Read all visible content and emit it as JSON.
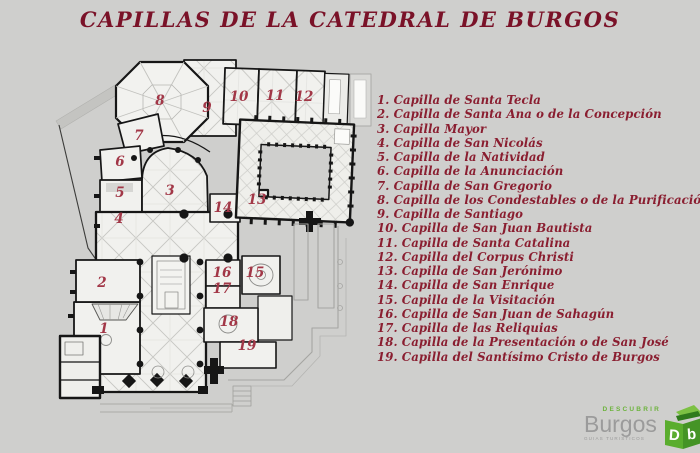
{
  "title": {
    "text": "CAPILLAS DE LA CATEDRAL DE BURGOS"
  },
  "colors": {
    "bg": "#cfcfcd",
    "title": "#7a1228",
    "legend": "#8a1e30",
    "plan_num": "#a23747",
    "logo_green": "#6cb33c",
    "logo_gray": "#9b9b9b"
  },
  "legend": {
    "items": [
      {
        "num": "1.",
        "name": "Capilla de Santa Tecla"
      },
      {
        "num": "2.",
        "name": "Capilla de Santa Ana o de la Concepción"
      },
      {
        "num": "3.",
        "name": "Capilla Mayor"
      },
      {
        "num": "4.",
        "name": "Capilla de San Nicolás"
      },
      {
        "num": "5.",
        "name": "Capilla de la Natividad"
      },
      {
        "num": "6.",
        "name": "Capilla de la Anunciación"
      },
      {
        "num": "7.",
        "name": "Capilla de San Gregorio"
      },
      {
        "num": "8.",
        "name": "Capilla de los Condestables o de la Purificación"
      },
      {
        "num": "9.",
        "name": "Capilla de Santiago"
      },
      {
        "num": "10.",
        "name": "Capilla de San Juan Bautista"
      },
      {
        "num": "11.",
        "name": "Capilla de Santa Catalina"
      },
      {
        "num": "12.",
        "name": "Capilla del Corpus Christi"
      },
      {
        "num": "13.",
        "name": "Capilla de San Jerónimo"
      },
      {
        "num": "14.",
        "name": "Capilla de San Enrique"
      },
      {
        "num": "15.",
        "name": "Capilla de la Visitación"
      },
      {
        "num": "16.",
        "name": "Capilla de San Juan de Sahagún"
      },
      {
        "num": "17.",
        "name": "Capilla de las Reliquias"
      },
      {
        "num": "18.",
        "name": "Capilla de la Presentación o de San José"
      },
      {
        "num": "19.",
        "name": "Capilla del Santísimo Cristo de Burgos"
      }
    ]
  },
  "plan": {
    "labels": [
      {
        "n": "1",
        "x": 104,
        "y": 329
      },
      {
        "n": "2",
        "x": 102,
        "y": 283
      },
      {
        "n": "3",
        "x": 170,
        "y": 191
      },
      {
        "n": "4",
        "x": 119,
        "y": 219
      },
      {
        "n": "5",
        "x": 120,
        "y": 193
      },
      {
        "n": "6",
        "x": 120,
        "y": 162
      },
      {
        "n": "7",
        "x": 139,
        "y": 136
      },
      {
        "n": "8",
        "x": 160,
        "y": 101
      },
      {
        "n": "9",
        "x": 207,
        "y": 108
      },
      {
        "n": "10",
        "x": 239,
        "y": 97
      },
      {
        "n": "11",
        "x": 275,
        "y": 96
      },
      {
        "n": "12",
        "x": 304,
        "y": 97
      },
      {
        "n": "13",
        "x": 257,
        "y": 200
      },
      {
        "n": "14",
        "x": 223,
        "y": 208
      },
      {
        "n": "15",
        "x": 255,
        "y": 273
      },
      {
        "n": "16",
        "x": 222,
        "y": 273
      },
      {
        "n": "17",
        "x": 222,
        "y": 289
      },
      {
        "n": "18",
        "x": 229,
        "y": 322
      },
      {
        "n": "19",
        "x": 247,
        "y": 346
      }
    ]
  },
  "logo": {
    "descubrir": "DESCUBRIR",
    "burgos": "Burgos",
    "tagline": "GUIAS TURISTICOS"
  }
}
